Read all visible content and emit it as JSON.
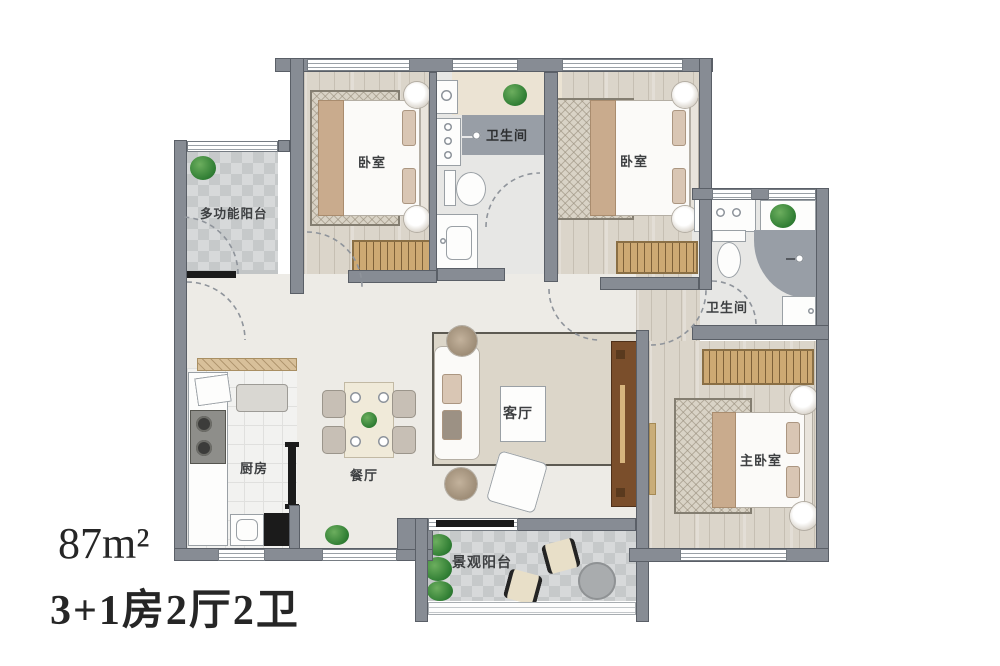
{
  "meta": {
    "area_label": "87m²",
    "config_label": "3+1房2厅2卫"
  },
  "rooms": {
    "multi_balcony": {
      "label": "多功能阳台"
    },
    "bedroom1": {
      "label": "卧室"
    },
    "bath1": {
      "label": "卫生间"
    },
    "bedroom2": {
      "label": "卧室"
    },
    "bath2": {
      "label": "卫生间"
    },
    "kitchen": {
      "label": "厨房"
    },
    "dining": {
      "label": "餐厅"
    },
    "living": {
      "label": "客厅"
    },
    "master": {
      "label": "主卧室"
    },
    "view_balcony": {
      "label": "景观阳台"
    }
  },
  "icons": {
    "plant": "plant-icon",
    "shower_head": "shower-head-icon",
    "door_swing": "door-swing-arc"
  },
  "colors": {
    "wall": "#878c94",
    "wood_floor": "#dbd5ca",
    "tile_gray": "#c6c9ca",
    "shower_gray": "#989ea6",
    "wardrobe_tan": "#cda973",
    "tv_console_wood": "#7a4e2b",
    "plant_green": "#2f7d33",
    "text_dark": "#262626"
  }
}
